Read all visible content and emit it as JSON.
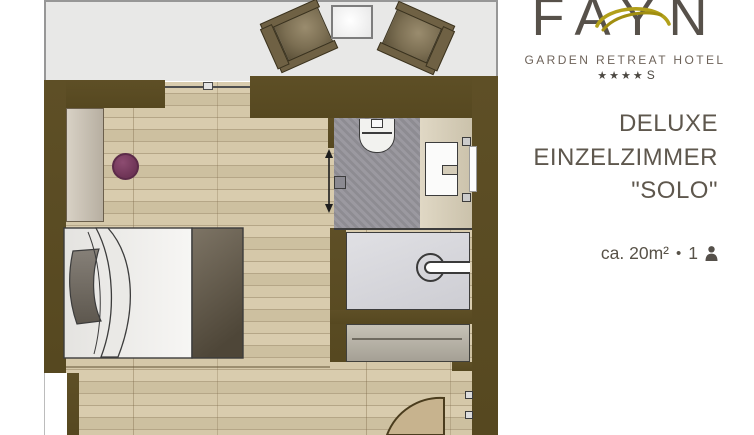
{
  "brand": {
    "name": "FAYN",
    "tagline": "GARDEN RETREAT HOTEL",
    "stars": "★★★★",
    "star_suffix": "S"
  },
  "room_info": {
    "category": "DELUXE",
    "type": "EINZELZIMMER",
    "name": "\"SOLO\"",
    "size": "ca. 20m²",
    "bullet": "•",
    "occupancy": "1"
  },
  "icons": {
    "occupancy": "person-silhouette",
    "sliding_door": "double-arrow-vertical",
    "shower": "shower-drain-circle",
    "entrance": "door-swing-arc"
  },
  "colors": {
    "wall_brown": "#5a4b24",
    "wood_floor": "#d3c6a7",
    "terrace_gray": "#e8e8e7",
    "accent_gold": "#b2a01a",
    "stool_purple": "#7e3f66",
    "bath_tile": "#95939a",
    "text_dark": "#57514a"
  }
}
